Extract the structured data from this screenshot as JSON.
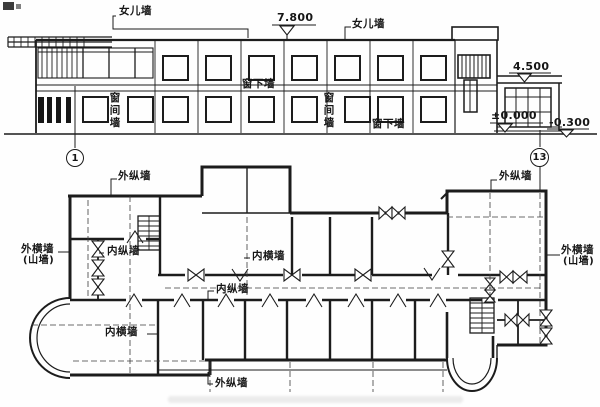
{
  "elevation": {
    "labels": {
      "parapet_left": "女儿墙",
      "parapet_right": "女儿墙",
      "spandrel_mid": "窗下墙",
      "spandrel_base": "窗下墙",
      "pier_left": "窗间墙",
      "pier_right": "窗间墙"
    },
    "levels": {
      "roof": "7.800",
      "porch_roof": "4.500",
      "floor_zero": "±0.000",
      "grade": "-0.300"
    },
    "axes": {
      "left": "1",
      "right": "13"
    }
  },
  "plan": {
    "labels": {
      "ext_longitudinal_top_left": "外纵墙",
      "ext_longitudinal_top_right": "外纵墙",
      "ext_longitudinal_bottom": "外纵墙",
      "ext_transverse_left": "外横墙",
      "ext_transverse_left_sub": "(山墙)",
      "ext_transverse_right": "外横墙",
      "ext_transverse_right_sub": "(山墙)",
      "int_longitudinal_left": "内纵墙",
      "int_longitudinal_mid": "内纵墙",
      "int_transverse_mid": "内横墙",
      "int_transverse_bottom_left": "内横墙"
    }
  }
}
